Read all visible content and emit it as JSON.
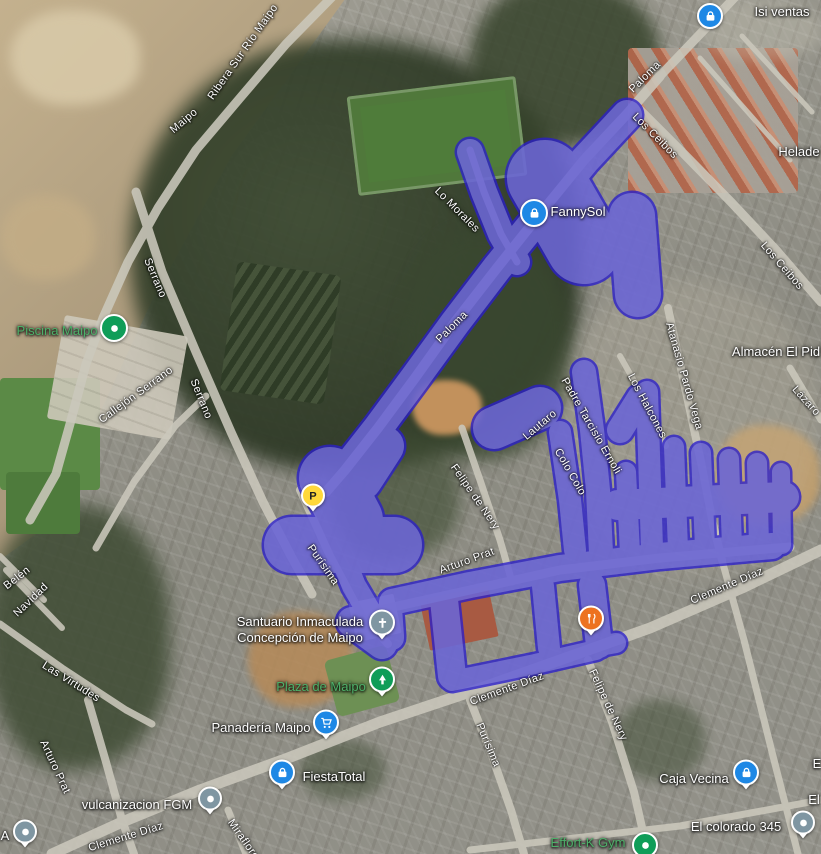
{
  "map": {
    "type": "satellite",
    "overlay": {
      "fill_color": "#9e9edd",
      "border_color": "#2a1ecb"
    },
    "road_color": "#cbc8bc"
  },
  "street_labels": [
    {
      "text": "Ribera Sur Río Maipo",
      "x": 243,
      "y": 52,
      "rot": -55
    },
    {
      "text": "Maipo",
      "x": 184,
      "y": 121,
      "rot": -40
    },
    {
      "text": "Serrano",
      "x": 155,
      "y": 278,
      "rot": 67
    },
    {
      "text": "Serrano",
      "x": 201,
      "y": 399,
      "rot": 68
    },
    {
      "text": "Callejón Serrano",
      "x": 136,
      "y": 395,
      "rot": -36
    },
    {
      "text": "Paloma",
      "x": 645,
      "y": 77,
      "rot": -45
    },
    {
      "text": "Los Ceibos",
      "x": 655,
      "y": 136,
      "rot": 45
    },
    {
      "text": "Los Ceibos",
      "x": 782,
      "y": 266,
      "rot": 49
    },
    {
      "text": "Lo Morales",
      "x": 457,
      "y": 210,
      "rot": 45
    },
    {
      "text": "Paloma",
      "x": 452,
      "y": 327,
      "rot": -45
    },
    {
      "text": "Atanasio Pardo Vega",
      "x": 684,
      "y": 376,
      "rot": 74
    },
    {
      "text": "Los Halcones",
      "x": 647,
      "y": 406,
      "rot": 62
    },
    {
      "text": "Lázaro",
      "x": 806,
      "y": 401,
      "rot": 48
    },
    {
      "text": "Padre Tarcisio Ernoli",
      "x": 591,
      "y": 426,
      "rot": 60
    },
    {
      "text": "Lautaro",
      "x": 540,
      "y": 425,
      "rot": -40
    },
    {
      "text": "Colo Colo",
      "x": 570,
      "y": 472,
      "rot": 60
    },
    {
      "text": "Felipe de Nery",
      "x": 475,
      "y": 497,
      "rot": 55
    },
    {
      "text": "Arturo Prat",
      "x": 467,
      "y": 561,
      "rot": -20
    },
    {
      "text": "Purísima",
      "x": 323,
      "y": 565,
      "rot": 55
    },
    {
      "text": "Clemente Díaz",
      "x": 727,
      "y": 586,
      "rot": -23
    },
    {
      "text": "Clemente Díaz",
      "x": 507,
      "y": 689,
      "rot": -20
    },
    {
      "text": "Purísima",
      "x": 488,
      "y": 745,
      "rot": 67
    },
    {
      "text": "Felipe de Nery",
      "x": 608,
      "y": 705,
      "rot": 65
    },
    {
      "text": "Las Virtudes",
      "x": 71,
      "y": 682,
      "rot": 32
    },
    {
      "text": "Belén",
      "x": 17,
      "y": 578,
      "rot": -38
    },
    {
      "text": "Navidad",
      "x": 31,
      "y": 600,
      "rot": -44
    },
    {
      "text": "Arturo Prat",
      "x": 55,
      "y": 767,
      "rot": 65
    },
    {
      "text": "Clemente Díaz",
      "x": 126,
      "y": 837,
      "rot": -17
    },
    {
      "text": "Miraflores",
      "x": 245,
      "y": 842,
      "rot": 55
    }
  ],
  "place_labels": [
    {
      "text": "Isi ventas",
      "x": 782,
      "y": 12
    },
    {
      "text": "FannySol",
      "x": 578,
      "y": 212
    },
    {
      "text": "Helade",
      "x": 799,
      "y": 152
    },
    {
      "text": "Almacén El Pid",
      "x": 776,
      "y": 352
    },
    {
      "text": "Piscina Maipo",
      "x": 57,
      "y": 331,
      "green": true
    },
    {
      "lines": [
        "Santuario Inmaculada",
        "Concepción de Maipo"
      ],
      "x": 300,
      "y": 630
    },
    {
      "text": "Plaza de Maipo",
      "x": 321,
      "y": 687,
      "green": true
    },
    {
      "text": "Panadería Maipo",
      "x": 261,
      "y": 728
    },
    {
      "text": "FiestaTotal",
      "x": 334,
      "y": 777
    },
    {
      "text": "vulcanizacion FGM",
      "x": 137,
      "y": 805
    },
    {
      "text": "Caja Vecina",
      "x": 694,
      "y": 779
    },
    {
      "text": "El colorado 345",
      "x": 736,
      "y": 827
    },
    {
      "text": "Effort-K Gym",
      "x": 588,
      "y": 843,
      "green": true
    },
    {
      "text": "A",
      "x": 5,
      "y": 836
    },
    {
      "text": "E",
      "x": 817,
      "y": 764
    },
    {
      "text": "El",
      "x": 814,
      "y": 800
    }
  ],
  "markers": [
    {
      "name": "isi-ventas-marker",
      "glyph": "bag",
      "color": "#1e88e5",
      "x": 710,
      "y": 16,
      "pin": false,
      "size": 22
    },
    {
      "name": "fannysol-marker",
      "glyph": "bag",
      "color": "#1e88e5",
      "x": 534,
      "y": 213,
      "pin": false,
      "size": 24
    },
    {
      "name": "piscina-maipo-marker",
      "glyph": "dot",
      "color": "#0f9d58",
      "x": 114,
      "y": 328,
      "pin": false,
      "size": 24
    },
    {
      "name": "santuario-church-marker",
      "glyph": "cross",
      "color": "#7f96a2",
      "x": 382,
      "y": 627,
      "pin": true,
      "size": 22
    },
    {
      "name": "plaza-de-maipo-marker",
      "glyph": "tree",
      "color": "#0f9d58",
      "x": 382,
      "y": 684,
      "pin": true,
      "size": 22
    },
    {
      "name": "panaderia-maipo-marker",
      "glyph": "cart",
      "color": "#1e88e5",
      "x": 326,
      "y": 727,
      "pin": true,
      "size": 22
    },
    {
      "name": "fiestatotal-marker",
      "glyph": "bag",
      "color": "#1e88e5",
      "x": 282,
      "y": 777,
      "pin": true,
      "size": 22
    },
    {
      "name": "vulcanizacion-fgm-marker",
      "glyph": "dot",
      "color": "#7f96a2",
      "x": 210,
      "y": 803,
      "pin": true,
      "size": 20
    },
    {
      "name": "caja-vecina-marker",
      "glyph": "bag",
      "color": "#1e88e5",
      "x": 746,
      "y": 777,
      "pin": true,
      "size": 22
    },
    {
      "name": "el-colorado-345-marker",
      "glyph": "dot",
      "color": "#7f96a2",
      "x": 803,
      "y": 827,
      "pin": true,
      "size": 20
    },
    {
      "name": "effort-k-gym-marker",
      "glyph": "dot",
      "color": "#0f9d58",
      "x": 645,
      "y": 845,
      "pin": false,
      "size": 22
    },
    {
      "name": "a-poi-marker",
      "glyph": "dot",
      "color": "#7f96a2",
      "x": 25,
      "y": 836,
      "pin": true,
      "size": 20
    },
    {
      "name": "parking-marker",
      "glyph": "P",
      "glyph_label": "P",
      "color": "#ffd83a",
      "x": 313,
      "y": 500,
      "pin": true,
      "size": 20
    },
    {
      "name": "restaurant-marker",
      "glyph": "restaurant",
      "color": "#ed7220",
      "x": 591,
      "y": 623,
      "pin": true,
      "size": 22
    }
  ]
}
